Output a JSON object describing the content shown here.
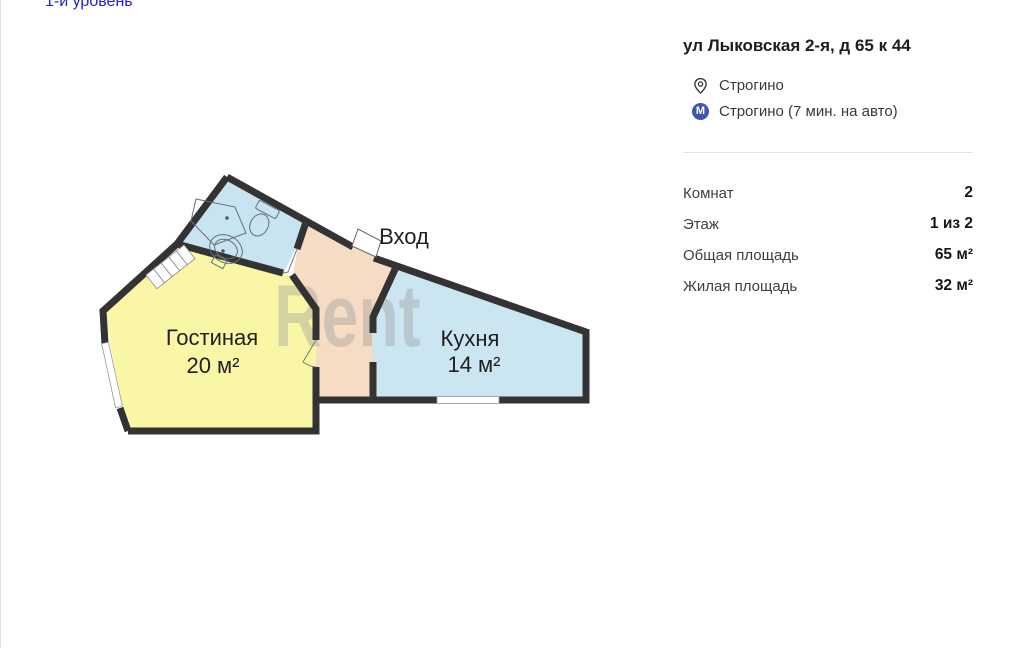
{
  "page": {
    "level_link": "1-й уровень"
  },
  "listing": {
    "title": "ул Лыковская 2-я, д 65 к 44",
    "location": {
      "district": "Строгино",
      "metro": "Строгино (7 мин. на авто)",
      "metro_badge": "М"
    },
    "details": [
      {
        "label": "Комнат",
        "value": "2"
      },
      {
        "label": "Этаж",
        "value": "1 из 2"
      },
      {
        "label": "Общая площадь",
        "value": "65 м²"
      },
      {
        "label": "Жилая площадь",
        "value": "32 м²"
      }
    ]
  },
  "floorplan": {
    "watermark": "Rent",
    "entrance_label": "Вход",
    "living": {
      "name": "Гостиная",
      "area": "20 м²",
      "color": "#f9f6a6"
    },
    "kitchen": {
      "name": "Кухня",
      "area": "14 м²",
      "color": "#cce6f1"
    },
    "bathroom": {
      "color": "#c7e4f0"
    },
    "hallway": {
      "color": "#f6dcc4"
    },
    "colors": {
      "wall": "#333333",
      "watermark": "#999999",
      "link": "#2323d6",
      "metro_badge_bg": "#3d56ae"
    }
  }
}
